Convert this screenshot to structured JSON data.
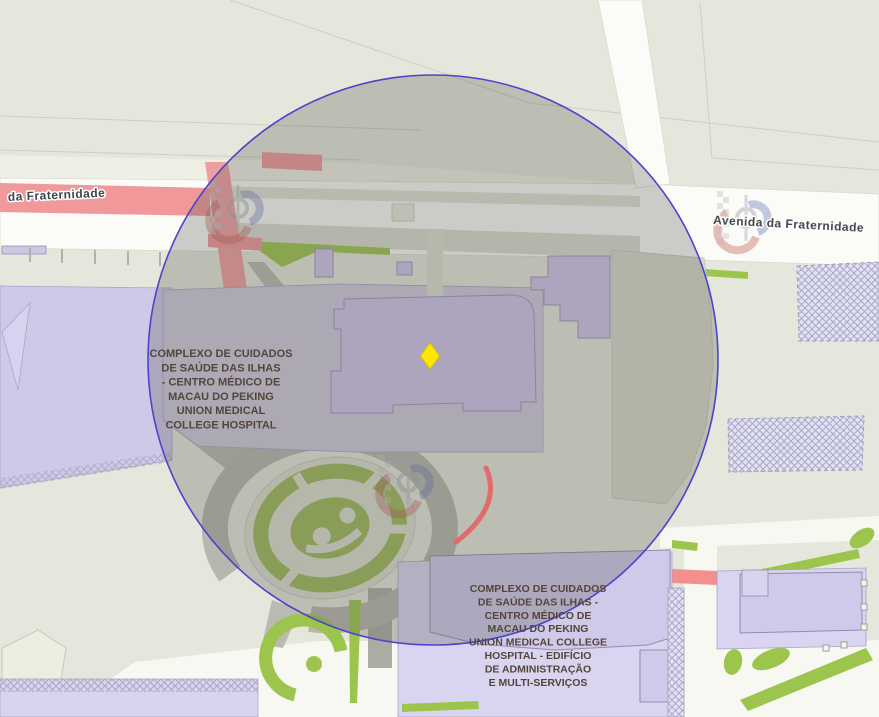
{
  "map": {
    "street_labels": [
      {
        "text": "da Fraternidade"
      },
      {
        "text": "Avenida da Fraternidade"
      }
    ],
    "poi_labels": {
      "hospital_main": {
        "lines": [
          "COMPLEXO DE CUIDADOS",
          "DE SAÚDE DAS ILHAS",
          "- CENTRO MÉDICO DE",
          "MACAU DO PEKING",
          "UNION MEDICAL",
          "COLLEGE HOSPITAL"
        ]
      },
      "hospital_admin": {
        "lines": [
          "COMPLEXO DE CUIDADOS",
          "DE SAÚDE DAS ILHAS -",
          "CENTRO MÉDICO DE",
          "MACAU DO PEKING",
          "UNION MEDICAL COLLEGE",
          "HOSPITAL - EDIFÍCIO",
          "DE ADMINISTRAÇÃO",
          "E MULTI-SERVIÇOS"
        ]
      }
    },
    "marker": {
      "shape": "diamond",
      "fill": "#ffe605"
    },
    "radius_circle": {
      "stroke": "#4b45cb",
      "fill": "rgba(92,92,86,0.30)"
    },
    "colors": {
      "background": "#e6e7dc",
      "building": "#cfc5ea",
      "parcel": "#d9d4ef",
      "road_white": "#fbfbf8",
      "road_pink": "#f0989a",
      "vegetation_green": "#9dc54d",
      "construction_hatch": "#e3e1f5",
      "label_brown": "#54453b",
      "street_label": "#3f444b"
    }
  }
}
